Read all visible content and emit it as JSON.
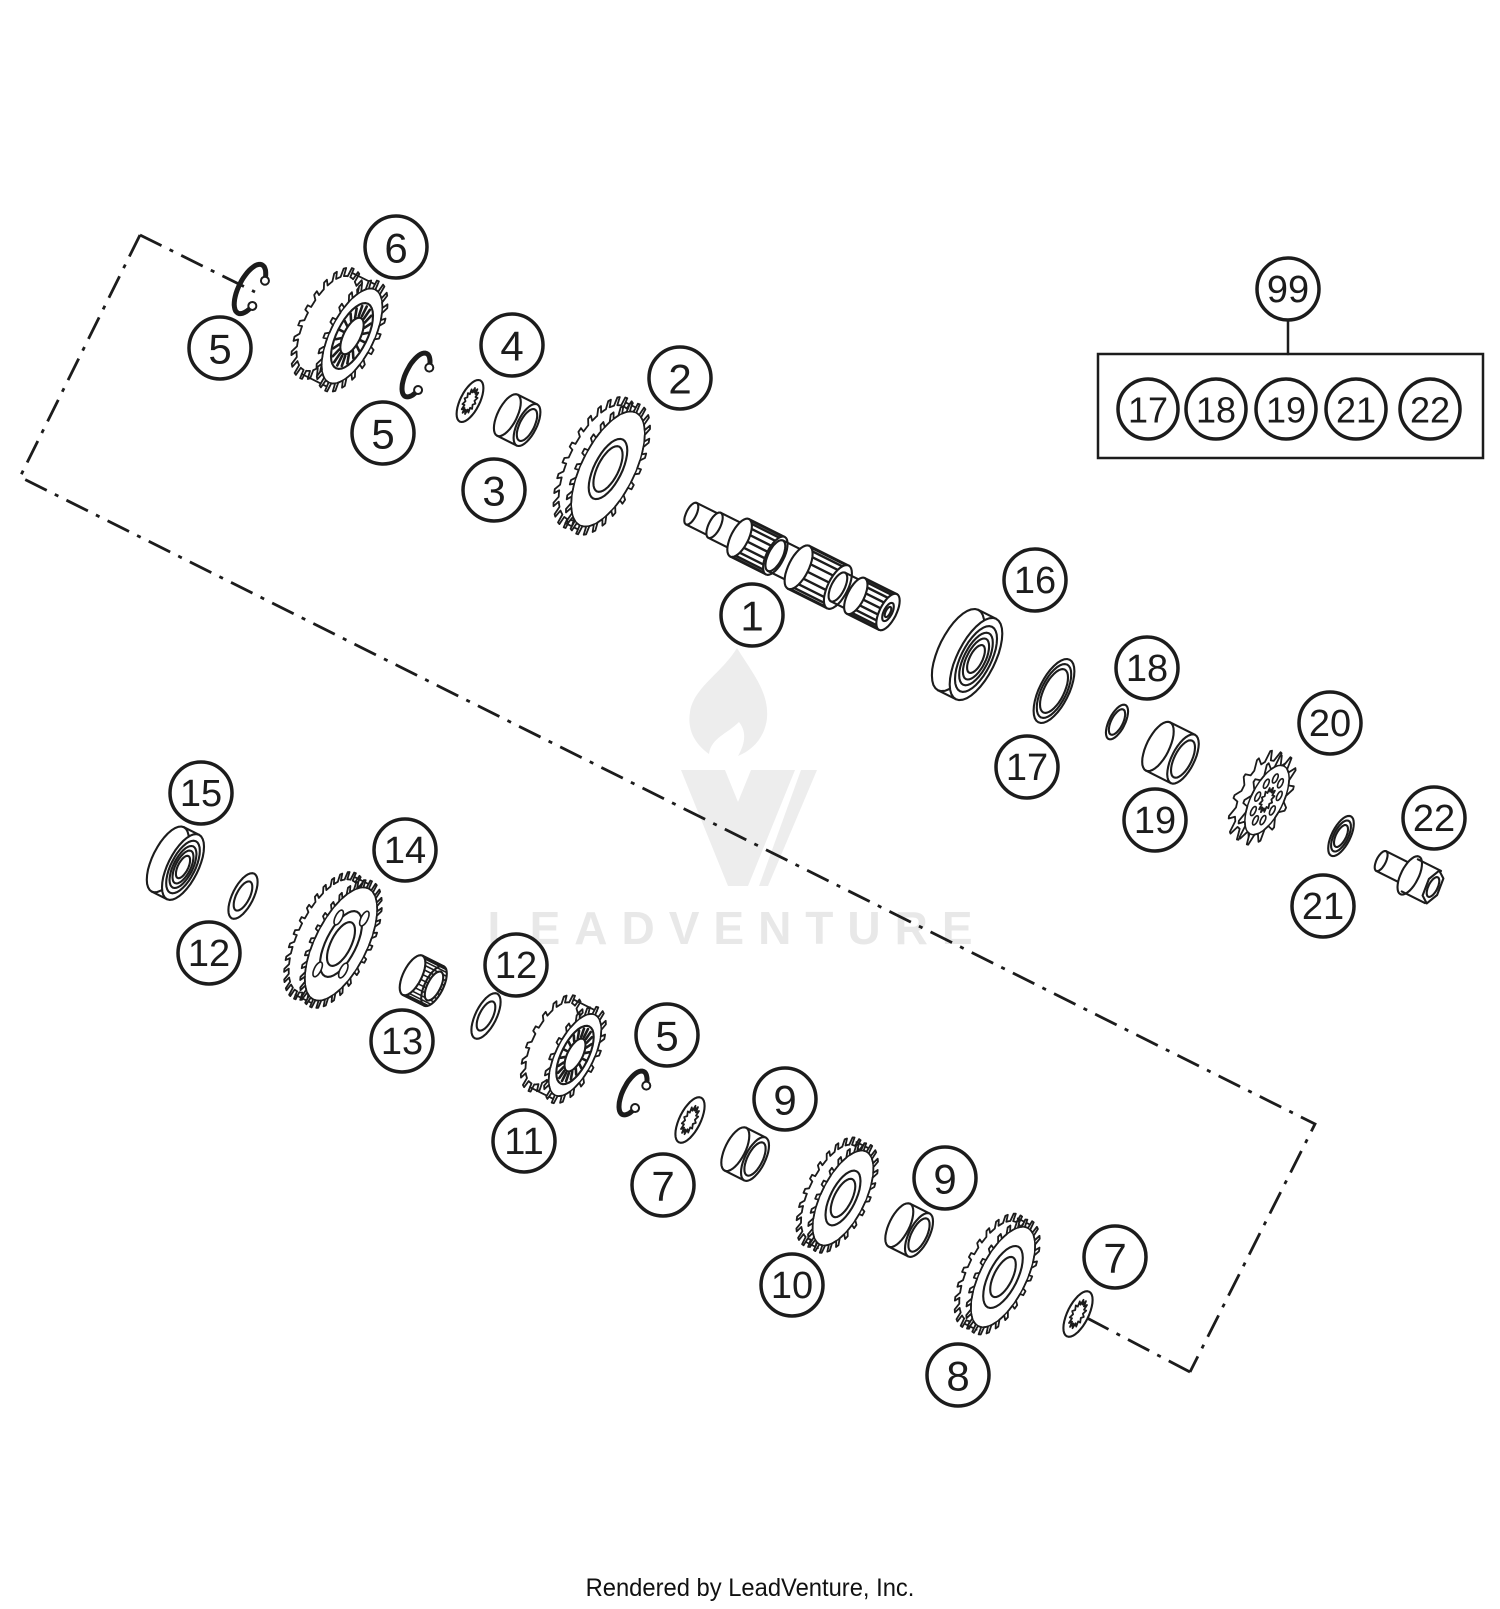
{
  "canvas": {
    "w": 1500,
    "h": 1609,
    "bg": "#ffffff",
    "ink": "#1c1c1c"
  },
  "watermark": {
    "text": "LEADVENTURE",
    "text_color": "#e8e8e8",
    "logo_color": "#ededed"
  },
  "footer": {
    "text": "Rendered by LeadVenture, Inc."
  },
  "callout_style": {
    "r": 31,
    "stroke": 3.5
  },
  "callouts": [
    {
      "n": "5",
      "x": 220,
      "y": 348
    },
    {
      "n": "6",
      "x": 396,
      "y": 247
    },
    {
      "n": "5",
      "x": 383,
      "y": 433
    },
    {
      "n": "4",
      "x": 512,
      "y": 345
    },
    {
      "n": "3",
      "x": 494,
      "y": 490
    },
    {
      "n": "2",
      "x": 680,
      "y": 378
    },
    {
      "n": "1",
      "x": 752,
      "y": 615
    },
    {
      "n": "16",
      "x": 1035,
      "y": 580
    },
    {
      "n": "17",
      "x": 1027,
      "y": 767
    },
    {
      "n": "18",
      "x": 1147,
      "y": 668
    },
    {
      "n": "19",
      "x": 1155,
      "y": 820
    },
    {
      "n": "20",
      "x": 1330,
      "y": 723
    },
    {
      "n": "22",
      "x": 1434,
      "y": 818
    },
    {
      "n": "21",
      "x": 1323,
      "y": 906
    },
    {
      "n": "15",
      "x": 201,
      "y": 793
    },
    {
      "n": "12",
      "x": 209,
      "y": 953
    },
    {
      "n": "14",
      "x": 405,
      "y": 850
    },
    {
      "n": "13",
      "x": 402,
      "y": 1041
    },
    {
      "n": "12",
      "x": 516,
      "y": 965
    },
    {
      "n": "11",
      "x": 524,
      "y": 1141
    },
    {
      "n": "5",
      "x": 667,
      "y": 1035
    },
    {
      "n": "7",
      "x": 663,
      "y": 1185
    },
    {
      "n": "9",
      "x": 785,
      "y": 1099
    },
    {
      "n": "10",
      "x": 792,
      "y": 1285
    },
    {
      "n": "9",
      "x": 945,
      "y": 1178
    },
    {
      "n": "8",
      "x": 958,
      "y": 1375
    },
    {
      "n": "7",
      "x": 1115,
      "y": 1257
    }
  ],
  "kit": {
    "badge": {
      "n": "99",
      "cx": 1288,
      "cy": 289,
      "r": 31
    },
    "connector": [
      [
        1288,
        320
      ],
      [
        1288,
        354
      ]
    ],
    "box": {
      "x": 1098,
      "y": 354,
      "w": 385,
      "h": 104
    },
    "item_r": 30,
    "items": [
      {
        "n": "17",
        "cx": 1148,
        "cy": 409
      },
      {
        "n": "18",
        "cx": 1216,
        "cy": 409
      },
      {
        "n": "19",
        "cx": 1286,
        "cy": 409
      },
      {
        "n": "21",
        "cx": 1356,
        "cy": 409
      },
      {
        "n": "22",
        "cx": 1430,
        "cy": 409
      }
    ]
  },
  "dash_pattern": "24 9 4 9",
  "dash_lines": [
    {
      "pts": [
        [
          140,
          235
        ],
        [
          20,
          477
        ],
        [
          1315,
          1124
        ],
        [
          1190,
          1372
        ]
      ]
    },
    {
      "pts": [
        [
          140,
          235
        ],
        [
          255,
          292
        ]
      ]
    },
    {
      "pts": [
        [
          1190,
          1372
        ],
        [
          1085,
          1317
        ]
      ]
    }
  ],
  "parts": [
    {
      "id": "circlip-5a",
      "type": "circlip",
      "cx": 250,
      "cy": 289,
      "R": 27
    },
    {
      "id": "gear-6",
      "type": "gear",
      "cx": 352,
      "cy": 336,
      "R": 52,
      "tooth": 9,
      "teeth": 22,
      "hub": 36,
      "bore": 20,
      "depth": 28,
      "dark": 1
    },
    {
      "id": "circlip-5b",
      "type": "circlip",
      "cx": 416,
      "cy": 375,
      "R": 24
    },
    {
      "id": "washer-4",
      "type": "spline_washer",
      "cx": 470,
      "cy": 401,
      "R": 23
    },
    {
      "id": "bushing-3",
      "type": "bushing",
      "cx": 527,
      "cy": 425,
      "R": 23,
      "depth": 22
    },
    {
      "id": "gear-2",
      "type": "gear",
      "cx": 608,
      "cy": 469,
      "R": 63,
      "tooth": 9,
      "teeth": 26,
      "hub": 33,
      "bore": 25,
      "depth": 14
    },
    {
      "id": "shaft-1",
      "type": "shaft",
      "cx": 888,
      "cy": 612,
      "segments": [
        {
          "len": 26,
          "R": 12
        },
        {
          "len": 28,
          "R": 14
        },
        {
          "len": 40,
          "R": 21,
          "splined": 1
        },
        {
          "len": 26,
          "R": 17
        },
        {
          "len": 44,
          "R": 24,
          "splined": 1
        },
        {
          "len": 20,
          "R": 16
        },
        {
          "len": 36,
          "R": 20,
          "splined": 1
        }
      ]
    },
    {
      "id": "bearing-16",
      "type": "bearing",
      "cx": 976,
      "cy": 659,
      "R": 45,
      "depth": 20
    },
    {
      "id": "seal-17",
      "type": "ring",
      "cx": 1054,
      "cy": 691,
      "R": 35,
      "r": 24,
      "extra": 1
    },
    {
      "id": "oring-18",
      "type": "ring",
      "cx": 1117,
      "cy": 722,
      "R": 19,
      "r": 14
    },
    {
      "id": "bushing-19",
      "type": "bushing",
      "cx": 1183,
      "cy": 759,
      "R": 27,
      "depth": 28
    },
    {
      "id": "sprocket-20",
      "type": "sprocket",
      "cx": 1267,
      "cy": 800,
      "R": 38,
      "tooth": 11,
      "teeth": 13,
      "depth": 11
    },
    {
      "id": "washer-21",
      "type": "ring",
      "cx": 1341,
      "cy": 836,
      "R": 22,
      "r": 12,
      "extra": 1
    },
    {
      "id": "bolt-22",
      "type": "bolt",
      "cx": 1433,
      "cy": 887,
      "R": 18
    },
    {
      "id": "bearing-15",
      "type": "bearing",
      "cx": 183,
      "cy": 867,
      "R": 36,
      "depth": 17
    },
    {
      "id": "washer-12a",
      "type": "ring",
      "cx": 243,
      "cy": 896,
      "R": 25,
      "r": 16
    },
    {
      "id": "gear-14",
      "type": "gear",
      "cx": 341,
      "cy": 944,
      "R": 62,
      "tooth": 8,
      "teeth": 30,
      "hub": 36,
      "bore": 24,
      "depth": 18,
      "cutouts": 4
    },
    {
      "id": "needle-13",
      "type": "needle",
      "cx": 434,
      "cy": 986,
      "R": 22,
      "depth": 24
    },
    {
      "id": "washer-12b",
      "type": "ring",
      "cx": 486,
      "cy": 1016,
      "R": 25,
      "r": 16
    },
    {
      "id": "gear-11",
      "type": "gear",
      "cx": 575,
      "cy": 1055,
      "R": 45,
      "tooth": 8,
      "teeth": 18,
      "hub": 32,
      "bore": 18,
      "depth": 26,
      "dark": 1
    },
    {
      "id": "circlip-5c",
      "type": "circlip",
      "cx": 633,
      "cy": 1093,
      "R": 24
    },
    {
      "id": "washer-7a",
      "type": "spline_washer",
      "cx": 690,
      "cy": 1120,
      "R": 25
    },
    {
      "id": "bushing-9a",
      "type": "bushing",
      "cx": 755,
      "cy": 1159,
      "R": 24,
      "depth": 22
    },
    {
      "id": "gear-10",
      "type": "gear",
      "cx": 843,
      "cy": 1198,
      "R": 52,
      "tooth": 8,
      "teeth": 24,
      "hub": 30,
      "bore": 21,
      "depth": 13
    },
    {
      "id": "bushing-9b",
      "type": "bushing",
      "cx": 919,
      "cy": 1235,
      "R": 24,
      "depth": 22
    },
    {
      "id": "gear-8",
      "type": "gear",
      "cx": 1003,
      "cy": 1277,
      "R": 55,
      "tooth": 8,
      "teeth": 24,
      "hub": 34,
      "bore": 22,
      "depth": 13
    },
    {
      "id": "washer-7b",
      "type": "spline_washer",
      "cx": 1078,
      "cy": 1314,
      "R": 25
    }
  ]
}
